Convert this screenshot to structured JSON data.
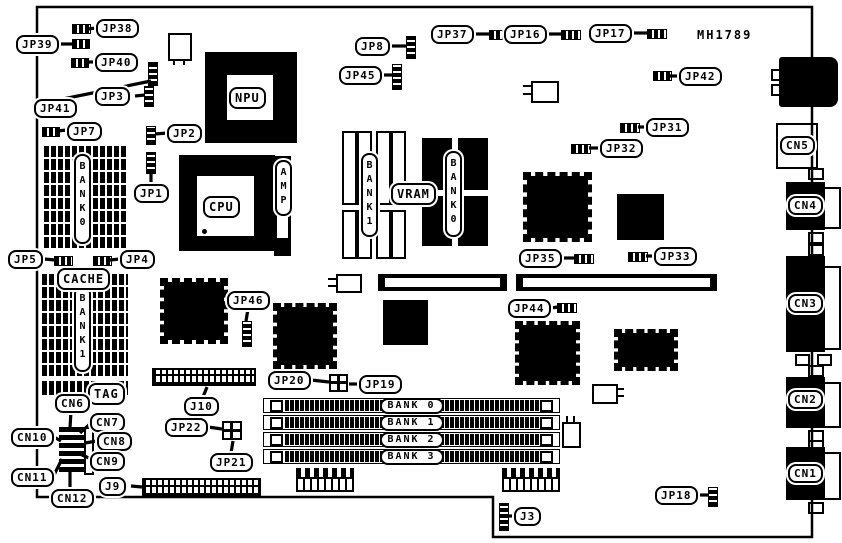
{
  "board_id": "MH1789",
  "labels": {
    "jp1": "JP1",
    "jp2": "JP2",
    "jp3": "JP3",
    "jp4": "JP4",
    "jp5": "JP5",
    "jp7": "JP7",
    "jp8": "JP8",
    "jp16": "JP16",
    "jp17": "JP17",
    "jp18": "JP18",
    "jp19": "JP19",
    "jp20": "JP20",
    "jp21": "JP21",
    "jp22": "JP22",
    "jp31": "JP31",
    "jp32": "JP32",
    "jp33": "JP33",
    "jp35": "JP35",
    "jp37": "JP37",
    "jp38": "JP38",
    "jp39": "JP39",
    "jp40": "JP40",
    "jp41": "JP41",
    "jp42": "JP42",
    "jp44": "JP44",
    "jp45": "JP45",
    "jp46": "JP46",
    "j3": "J3",
    "j9": "J9",
    "j10": "J10",
    "cn1": "CN1",
    "cn2": "CN2",
    "cn3": "CN3",
    "cn4": "CN4",
    "cn5": "CN5",
    "cn6": "CN6",
    "cn7": "CN7",
    "cn8": "CN8",
    "cn9": "CN9",
    "cn10": "CN10",
    "cn11": "CN11",
    "cn12": "CN12"
  },
  "chips": {
    "npu": "NPU",
    "cpu": "CPU",
    "amp": "AMP",
    "cache": "CACHE",
    "vram": "VRAM",
    "tag": "TAG",
    "bank0_left": "BANK0",
    "bank1_cache": "BANK1",
    "bank1_video": "BANK1",
    "bank0_video": "BANK0"
  },
  "memory_slots": [
    {
      "label": "BANK 0"
    },
    {
      "label": "BANK 1"
    },
    {
      "label": "BANK 2"
    },
    {
      "label": "BANK 3"
    }
  ]
}
